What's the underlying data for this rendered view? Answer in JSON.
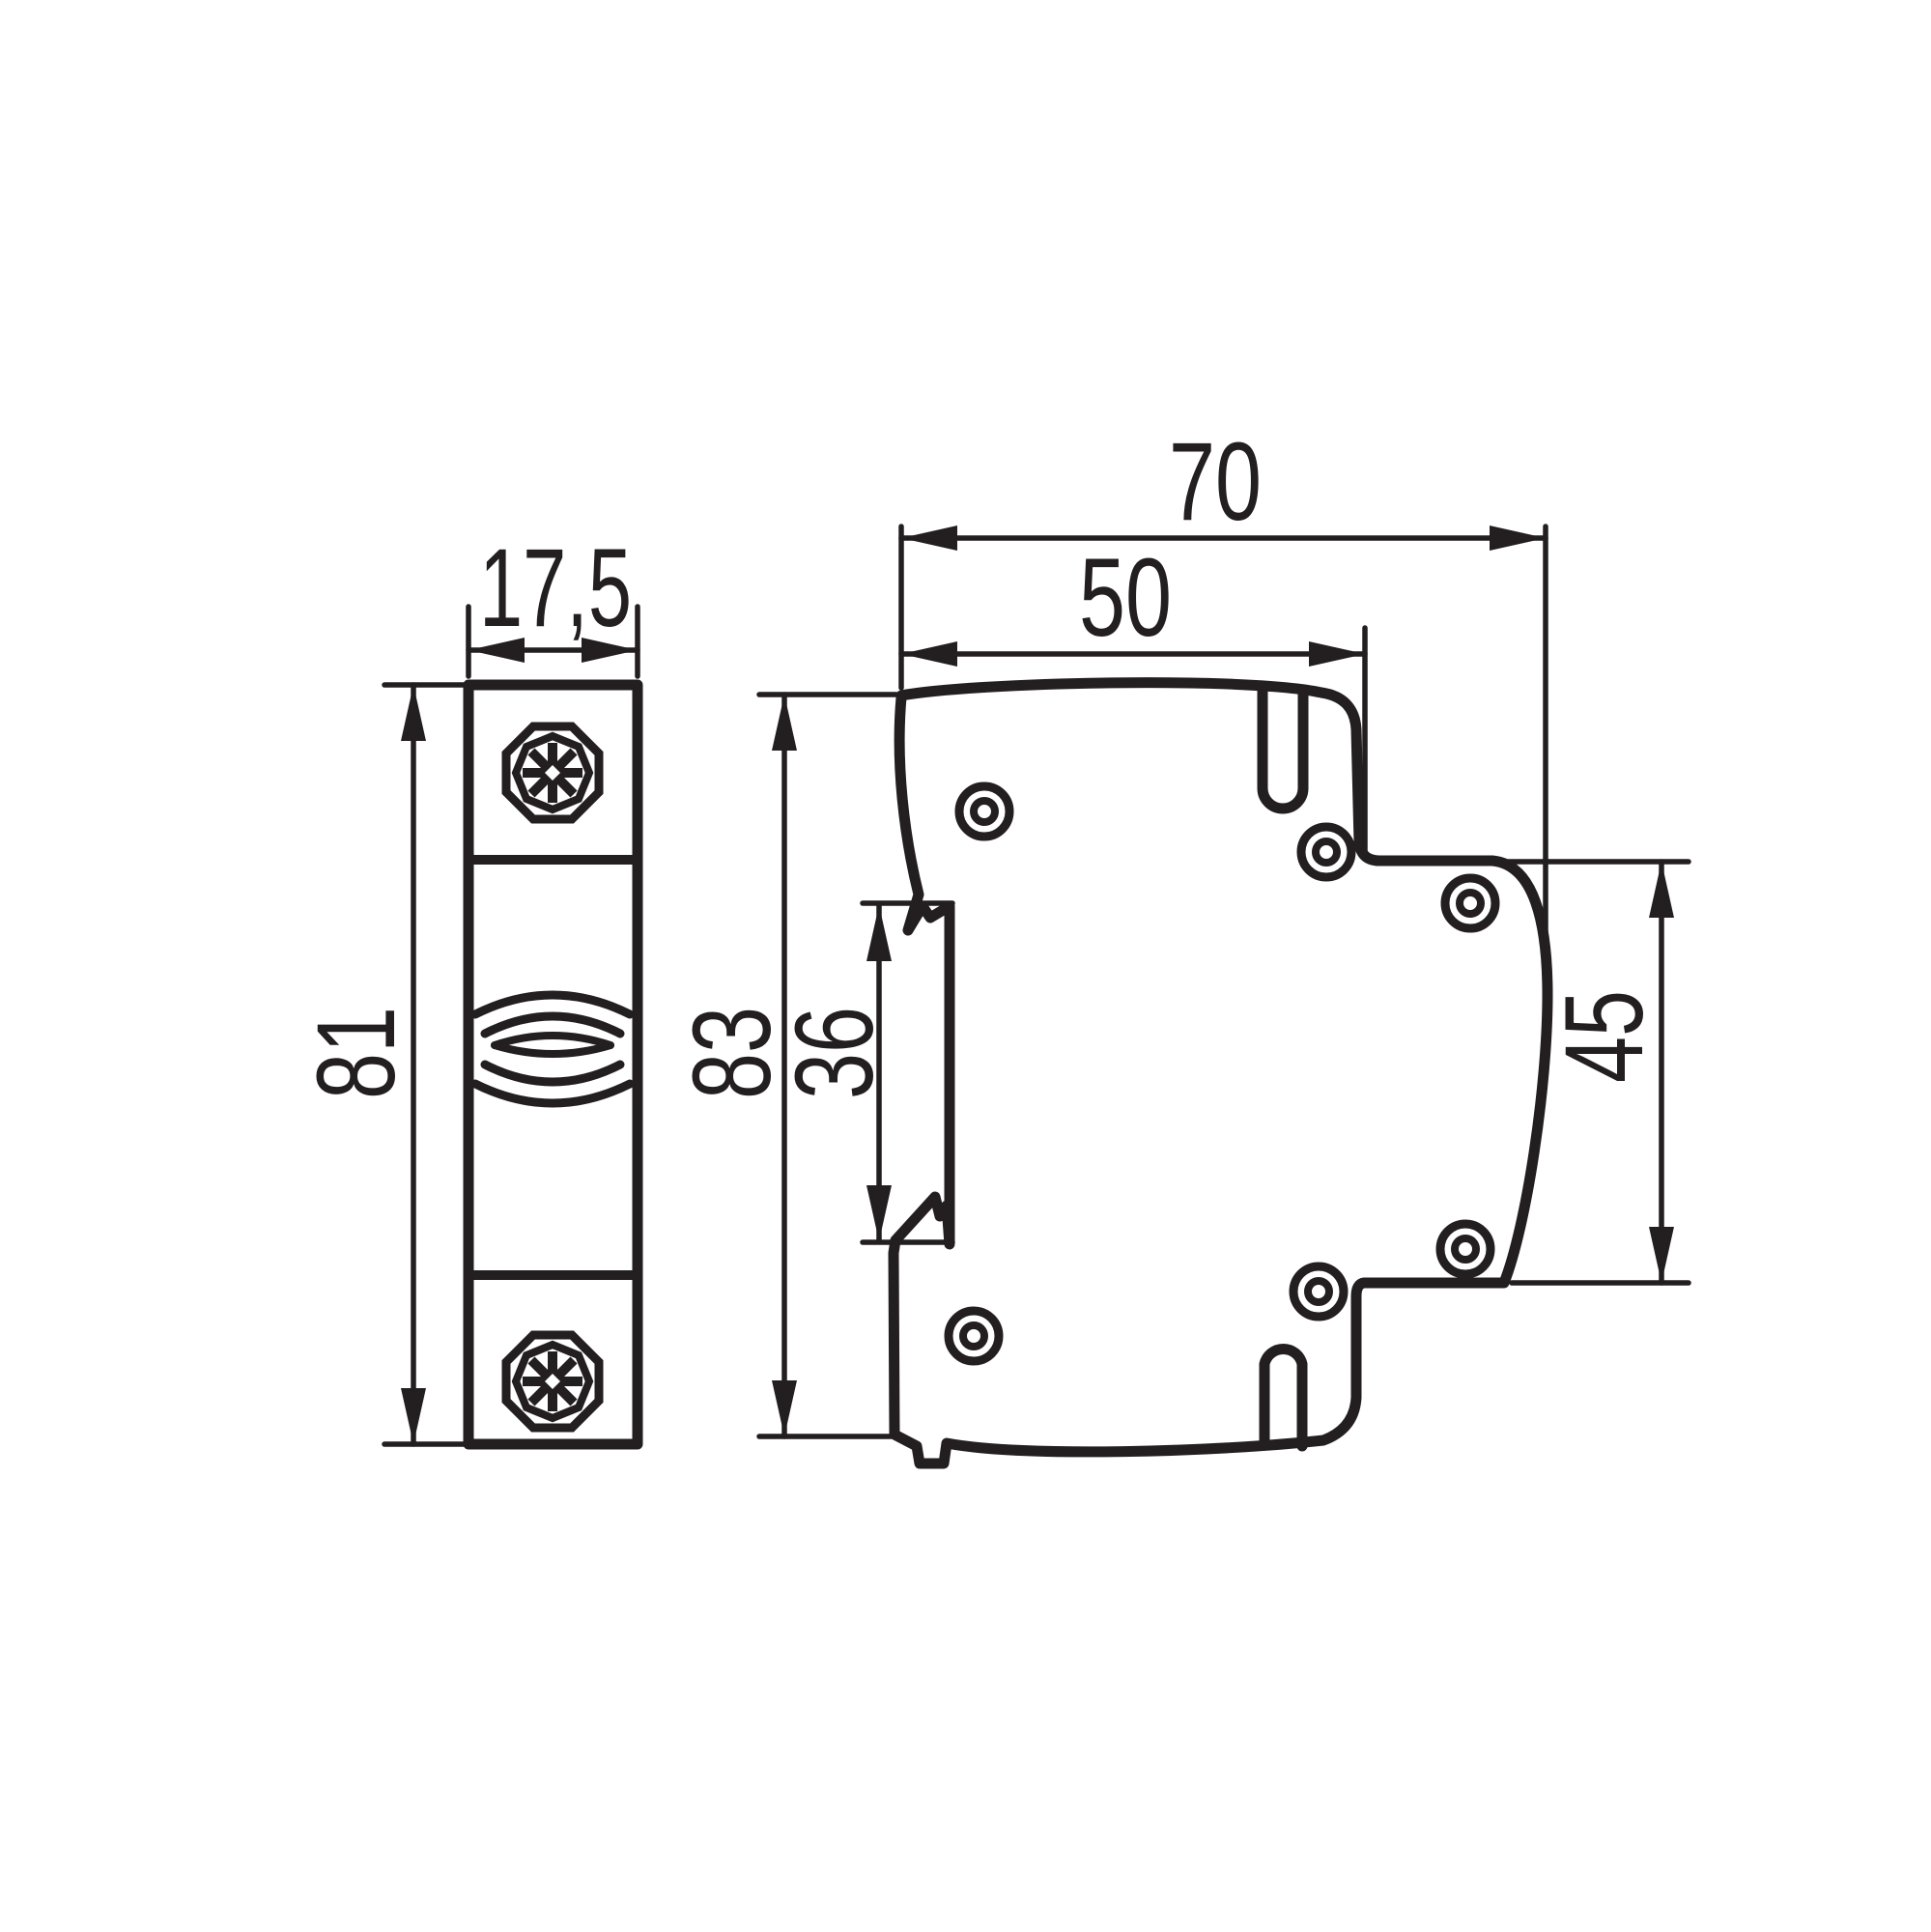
{
  "page": {
    "background": "#ffffff",
    "line_color": "#231f20",
    "description": "Technical dimension drawing, DIN-rail modular device, front and side views"
  },
  "views": {
    "front": {
      "width": "17,5",
      "height": "81"
    },
    "side": {
      "width_total": "70",
      "width_upper": "50",
      "height": "83",
      "rail_recess": "36",
      "rear_height": "45"
    }
  }
}
